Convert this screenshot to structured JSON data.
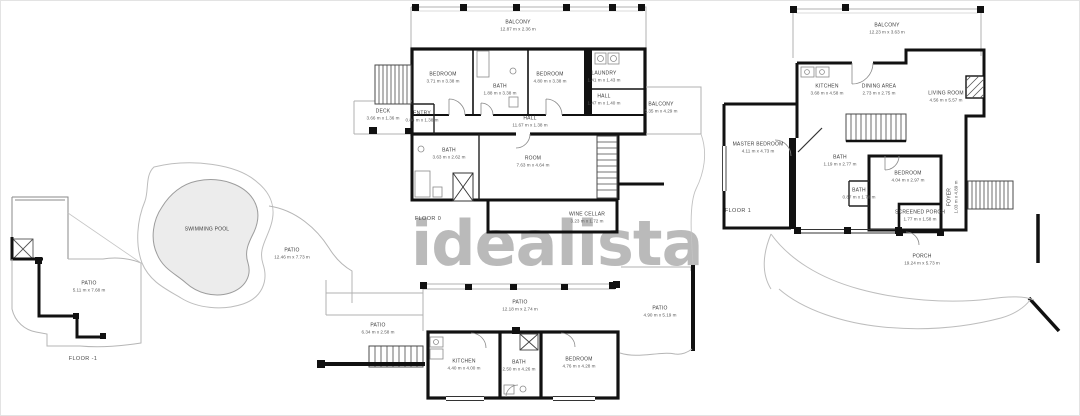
{
  "watermark": {
    "text": "idealista",
    "color": "#b5b5b5"
  },
  "colors": {
    "walls": "#111111",
    "thin_outline": "#b0b0b0",
    "pool_fill": "#ececec",
    "label_text": "#3c3c3c"
  },
  "floors": {
    "floor0": {
      "label": "FLOOR 0",
      "rooms": {
        "balcony_top": {
          "name": "BALCONY",
          "dims": "12.87 m x 2.36 m"
        },
        "bedroom_left": {
          "name": "BEDROOM",
          "dims": "3.71 m x 3.38 m"
        },
        "bath_center": {
          "name": "BATH",
          "dims": "1.88 m x 3.38 m"
        },
        "bedroom_right": {
          "name": "BEDROOM",
          "dims": "4.80 m x 3.38 m"
        },
        "laundry": {
          "name": "LAUNDRY",
          "dims": "1.41 m x 1.43 m"
        },
        "hall_small": {
          "name": "HALL",
          "dims": "1.47 m x 1.40 m"
        },
        "balcony_right": {
          "name": "BALCONY",
          "dims": "5.35 m x 4.29 m"
        },
        "deck": {
          "name": "DECK",
          "dims": "3.66 m x 1.36 m"
        },
        "entry": {
          "name": "ENTRY",
          "dims": "0.84 m x 1.38 m"
        },
        "hall": {
          "name": "HALL",
          "dims": "11.67 m x 1.38 m"
        },
        "bath_left": {
          "name": "BATH",
          "dims": "3.63 m x 2.62 m"
        },
        "room": {
          "name": "ROOM",
          "dims": "7.63 m x 4.64 m"
        },
        "wine_cellar": {
          "name": "WINE CELLAR",
          "dims": "3.23 m x 1.72 m"
        }
      }
    },
    "floor_minus1": {
      "label": "FLOOR -1",
      "rooms": {
        "patio_left": {
          "name": "PATIO",
          "dims": "5.11 m x 7.68 m"
        },
        "swimming_pool": {
          "name": "SWIMMING POOL",
          "dims": ""
        },
        "patio_pool": {
          "name": "PATIO",
          "dims": "12.46 m x 7.73 m"
        },
        "patio_stairs": {
          "name": "PATIO",
          "dims": "6.34 m x 2.58 m"
        },
        "patio_top": {
          "name": "PATIO",
          "dims": "12.18 m x 2.74 m"
        },
        "kitchen": {
          "name": "KITCHEN",
          "dims": "4.40 m x 4.00 m"
        },
        "bath": {
          "name": "BATH",
          "dims": "2.50 m x 4.26 m"
        },
        "bedroom": {
          "name": "BEDROOM",
          "dims": "4.76 m x 4.28 m"
        },
        "patio_right": {
          "name": "PATIO",
          "dims": "4.90 m x 5.19 m"
        }
      }
    },
    "floor1": {
      "label": "FLOOR 1",
      "rooms": {
        "balcony": {
          "name": "BALCONY",
          "dims": "12.23 m x 3.63 m"
        },
        "kitchen": {
          "name": "KITCHEN",
          "dims": "3.68 m x 4.58 m"
        },
        "dining": {
          "name": "DINING AREA",
          "dims": "2.73 m x 2.75 m"
        },
        "living": {
          "name": "LIVING ROOM",
          "dims": "4.56 m x 5.57 m"
        },
        "master": {
          "name": "MASTER BEDROOM",
          "dims": "4.11 m x 4.73 m"
        },
        "bath_main": {
          "name": "BATH",
          "dims": "1.19 m x 2.77 m"
        },
        "bedroom": {
          "name": "BEDROOM",
          "dims": "4.04 m x 2.97 m"
        },
        "bath_small": {
          "name": "BATH",
          "dims": "0.87 m x 1.78 m"
        },
        "foyer": {
          "name": "FOYER",
          "dims": "1.03 m x 4.89 m"
        },
        "screened_porch": {
          "name": "SCREENED PORCH",
          "dims": "1.77 m x 1.58 m"
        },
        "porch": {
          "name": "PORCH",
          "dims": "19.24 m x 5.73 m"
        }
      }
    }
  }
}
